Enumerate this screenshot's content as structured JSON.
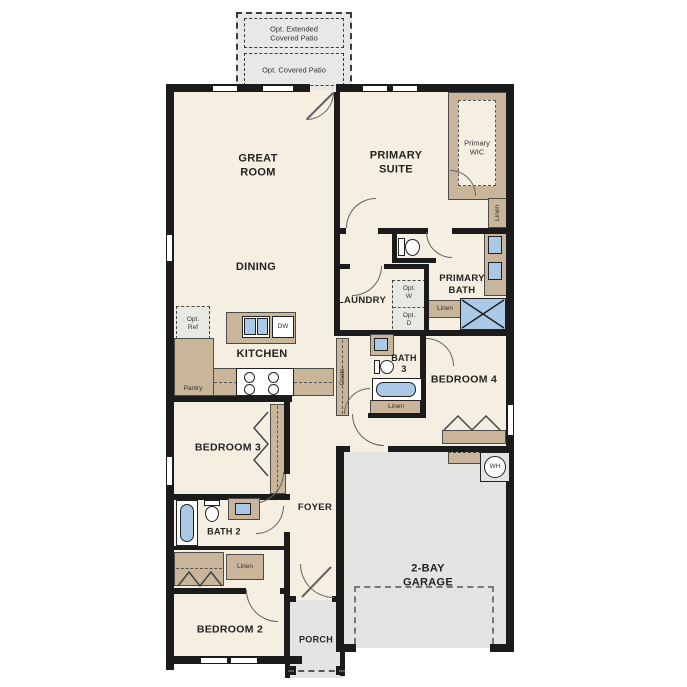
{
  "meta": {
    "type": "single-story floor plan"
  },
  "colors": {
    "floor": "#f5efe1",
    "wall": "#1b1b1b",
    "cabinet_tan": "#c8b59a",
    "fixture_blue": "#a9c9e6",
    "garage_gray": "#e3e3e1",
    "patio_gray": "#e8e8e6"
  },
  "labels": {
    "opt_extended_patio": "Opt. Extended\nCovered Patio",
    "opt_covered_patio": "Opt. Covered Patio",
    "great_room": "GREAT\nROOM",
    "dining": "DINING",
    "primary_suite": "PRIMARY\nSUITE",
    "primary_wic": "Primary\nWIC",
    "linen_wic": "Linen",
    "primary_bath": "PRIMARY\nBATH",
    "laundry": "LAUNDRY",
    "opt_w": "Opt.\nW",
    "opt_d": "Opt.\nD",
    "linen_bath": "Linen",
    "opt_ref": "Opt.\nRef",
    "kitchen": "KITCHEN",
    "dw": "DW",
    "pantry": "Pantry",
    "bath3": "BATH\n3",
    "linen_bath3": "Linen",
    "coats": "Coats",
    "bedroom4": "BEDROOM 4",
    "bedroom3": "BEDROOM 3",
    "foyer": "FOYER",
    "bath2": "BATH 2",
    "linen_hall": "Linen",
    "bedroom2": "BEDROOM 2",
    "porch": "PORCH",
    "garage": "2-BAY\nGARAGE",
    "water_heater": "WH"
  }
}
